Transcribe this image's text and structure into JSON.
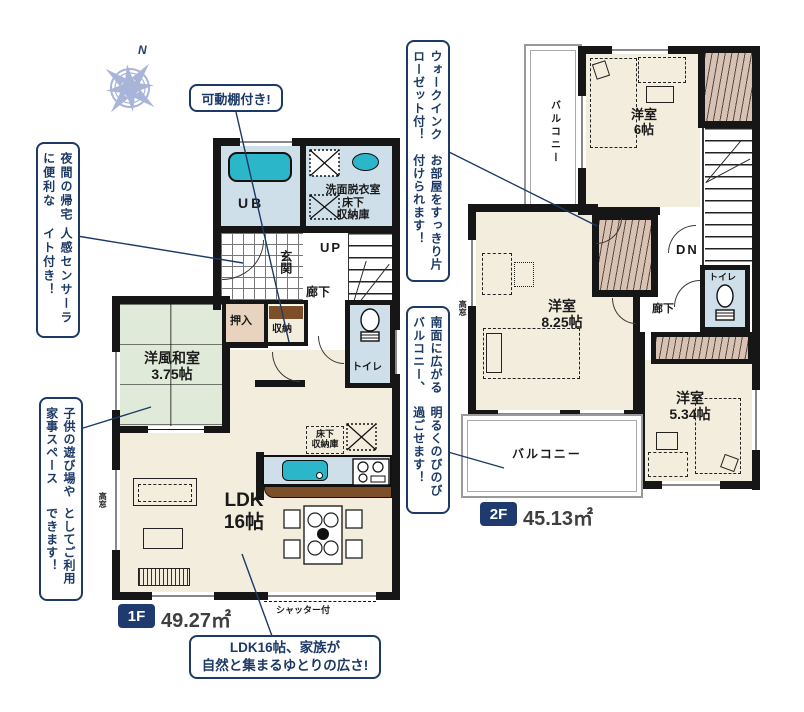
{
  "colors": {
    "navy": "#1d3a66",
    "fixture_cyan": "#2bb6ca",
    "room_cream": "#f2eddc",
    "wet_room_blue": "#cfdfe9",
    "tatami_green": "#dfead8",
    "closet_tan": "#e8d3bf",
    "wood_brown": "#7d4f28",
    "closet_pink": "#d8c2b3",
    "compass_blue": "#a9b4d9"
  },
  "compass": {
    "north_label": "N"
  },
  "callouts": {
    "shelf": "可動棚付き!",
    "sensor_col1": "夜間の帰宅に便利な",
    "sensor_col2": "人感センサーライト付き！",
    "kids_col1": "子供の遊び場や家事スペース",
    "kids_col2": "としてご利用できます！",
    "wic_col1": "ウォークインクローゼット付！",
    "wic_col2": "お部屋をすっきり片付けられます！",
    "south_col1": "南面に広がるバルコニー、",
    "south_col2": "明るくのびのび過ごせます！",
    "ldk_line1": "LDK16帖、家族が",
    "ldk_line2": "自然と集まるゆとりの広さ!"
  },
  "floor1": {
    "badge": "1F",
    "area": "49.27㎡",
    "rooms": {
      "ub": "UB",
      "wash1": "洗面脱衣室",
      "wash2": "床下",
      "wash3": "収納庫",
      "genkan": "玄関",
      "up": "UP",
      "hallway": "廊下",
      "oshiire": "押入",
      "shuno": "収納",
      "toilet": "トイレ",
      "tatami1": "洋風和室",
      "tatami2": "3.75帖",
      "ldk1": "LDK",
      "ldk2": "16帖",
      "yukashita1": "床下",
      "yukashita2": "収納庫",
      "takamado": "高窓",
      "shutter": "シャッター付"
    }
  },
  "floor2": {
    "badge": "2F",
    "area": "45.13㎡",
    "rooms": {
      "balcony_west": "バルコニー",
      "room6_1": "洋室",
      "room6_2": "6帖",
      "room825_1": "洋室",
      "room825_2": "8.25帖",
      "room534_1": "洋室",
      "room534_2": "5.34帖",
      "dn": "DN",
      "toilet": "トイレ",
      "hallway": "廊下",
      "balcony_south": "バルコニー",
      "takamado": "高窓"
    }
  }
}
